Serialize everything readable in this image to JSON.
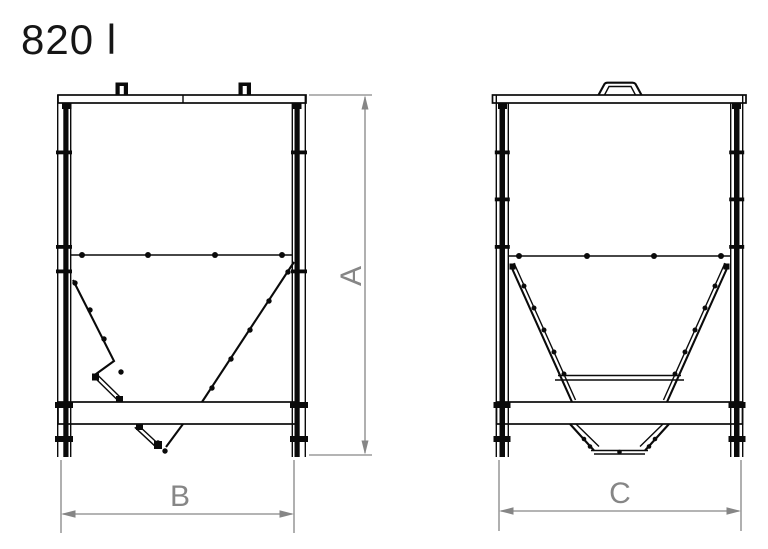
{
  "title": "820 l",
  "drawing": {
    "dimension_labels": {
      "a": "A",
      "b": "B",
      "c": "C"
    }
  },
  "colors": {
    "line": "#0a0a0a",
    "dimension": "#868686",
    "title_text": "#161616",
    "background": "#ffffff"
  }
}
